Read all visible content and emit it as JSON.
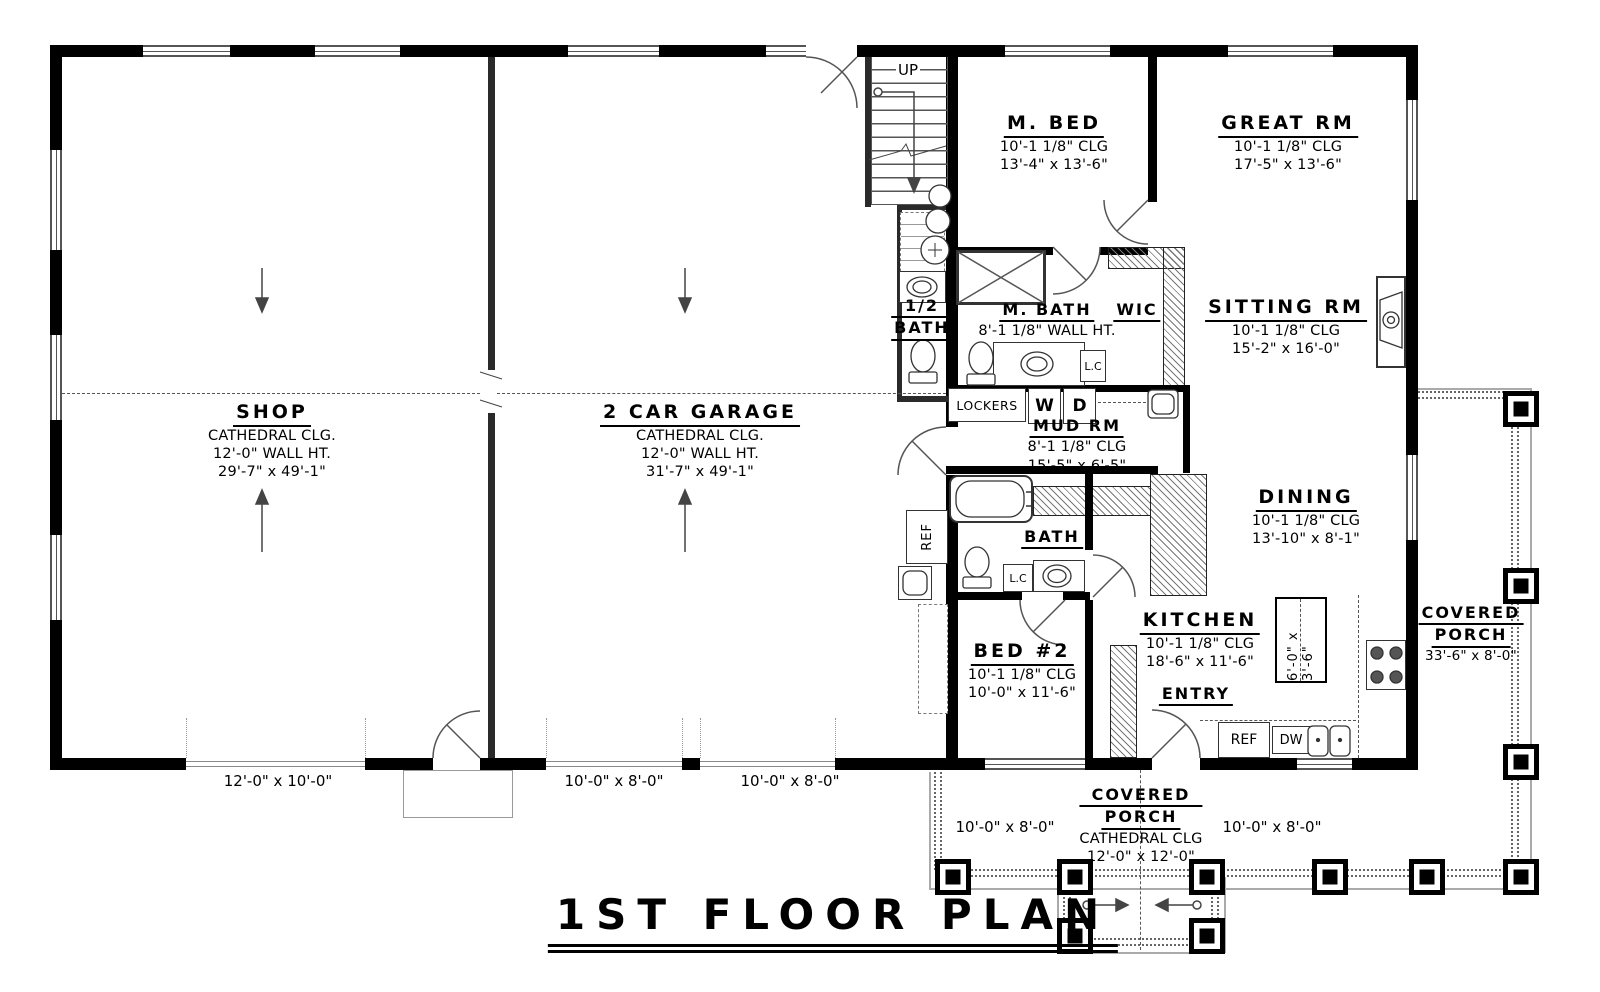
{
  "title": "1ST FLOOR PLAN",
  "rooms": {
    "shop": {
      "name": "SHOP",
      "l1": "CATHEDRAL CLG.",
      "l2": "12'-0\" WALL HT.",
      "l3": "29'-7\" x 49'-1\""
    },
    "garage": {
      "name": "2 CAR GARAGE",
      "l1": "CATHEDRAL CLG.",
      "l2": "12'-0\" WALL HT.",
      "l3": "31'-7\" x 49'-1\""
    },
    "mbed": {
      "name": "M. BED",
      "l1": "10'-1 1/8\" CLG",
      "l2": "13'-4\" x 13'-6\""
    },
    "great": {
      "name": "GREAT RM",
      "l1": "10'-1 1/8\" CLG",
      "l2": "17'-5\" x 13'-6\""
    },
    "mbath": {
      "name": "M. BATH",
      "l1": "8'-1 1/8\" WALL HT."
    },
    "wic": {
      "name": "WIC"
    },
    "halfbath": {
      "name1": "1/2",
      "name2": "BATH"
    },
    "sitting": {
      "name": "SITTING RM",
      "l1": "10'-1 1/8\" CLG",
      "l2": "15'-2\" x 16'-0\""
    },
    "mud": {
      "name": "MUD RM",
      "l1": "8'-1 1/8\" CLG",
      "l2": "15'-5\" x 6'-5\""
    },
    "dining": {
      "name": "DINING",
      "l1": "10'-1 1/8\" CLG",
      "l2": "13'-10\" x 8'-1\""
    },
    "bath": {
      "name": "BATH"
    },
    "bed2": {
      "name": "BED #2",
      "l1": "10'-1 1/8\" CLG",
      "l2": "10'-0\" x 11'-6\""
    },
    "kitchen": {
      "name": "KITCHEN",
      "l1": "10'-1 1/8\" CLG",
      "l2": "18'-6\" x 11'-6\""
    },
    "entry": {
      "name": "ENTRY"
    },
    "porch_right": {
      "name1": "COVERED",
      "name2": "PORCH",
      "l1": "33'-6\" x 8'-0\""
    },
    "porch_bottom": {
      "name1": "COVERED",
      "name2": "PORCH",
      "l1": "CATHEDRAL CLG",
      "l2": "12'-0\" x 12'-0\""
    }
  },
  "fixtures": {
    "up": "UP",
    "lockers": "LOCKERS",
    "washer": "W",
    "dryer": "D",
    "lc": "L.C",
    "ref": "REF",
    "dw": "DW",
    "island_dim": "6'-0\" x 3'-6\""
  },
  "door_dims": {
    "shop_door": "12'-0\" x 10'-0\"",
    "garage_door_1": "10'-0\" x 8'-0\"",
    "garage_door_2": "10'-0\" x 8'-0\"",
    "porch_bay_left": "10'-0\" x 8'-0\"",
    "porch_bay_right": "10'-0\" x 8'-0\""
  },
  "colors": {
    "wall": "#000000",
    "line": "#555555",
    "hatch": "#777777"
  }
}
